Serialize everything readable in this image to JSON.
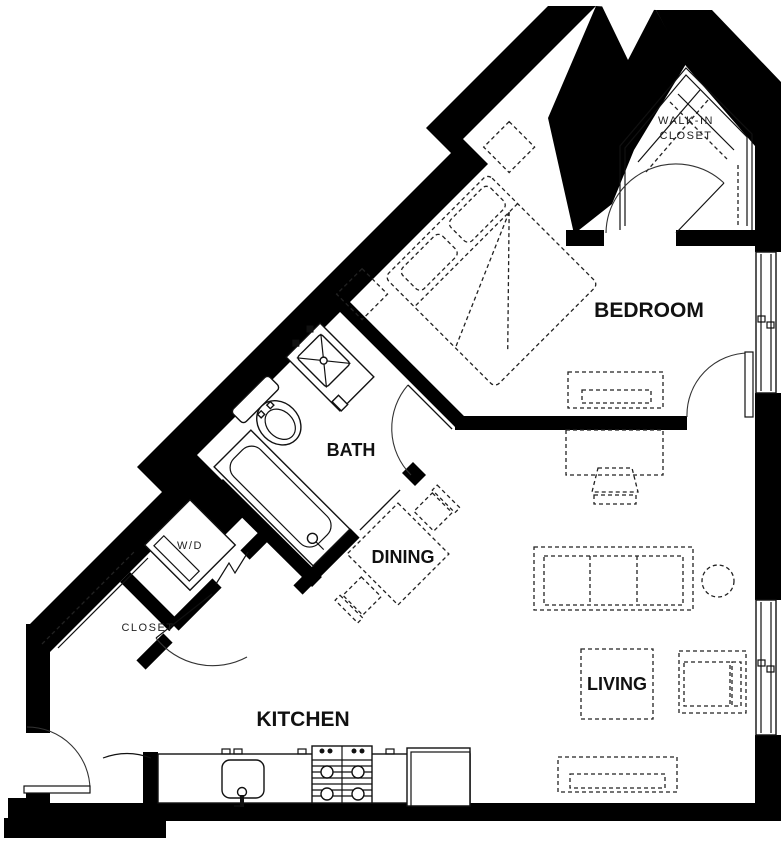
{
  "plan": {
    "title": "apartment-floor-plan",
    "rooms": {
      "bedroom": "BEDROOM",
      "bath": "BATH",
      "dining": "DINING",
      "living": "LIVING",
      "kitchen": "KITCHEN",
      "closet": "CLOSET",
      "walk_in_line1": "WALK-IN",
      "walk_in_line2": "CLOSET",
      "washer_dryer": "W/D"
    },
    "colors": {
      "wall": "#000000",
      "background": "#ffffff",
      "furniture_line": "#222222"
    }
  }
}
